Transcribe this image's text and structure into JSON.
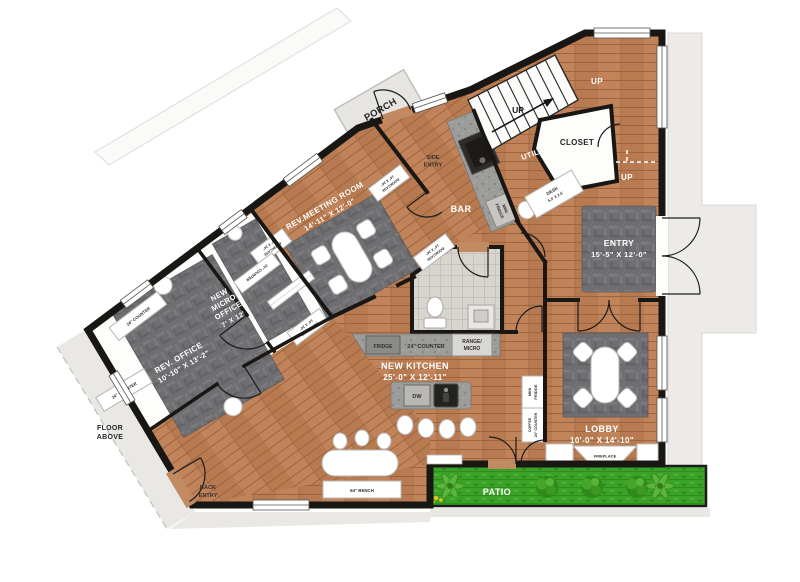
{
  "plan": {
    "rooms": {
      "meeting": {
        "name": "REV.MEETING ROOM",
        "dims": "14'-11\" X 12'-0\""
      },
      "micro": {
        "l1": "NEW",
        "l2": "MICRO",
        "l3": "OFFICE",
        "dims": "7' X 12'"
      },
      "office": {
        "name": "REV. OFFICE",
        "dims": "10'-10\" X 13'-2\""
      },
      "entry": {
        "name": "ENTRY",
        "dims": "15'-5\" X 12'-0\""
      },
      "kitchen": {
        "name": "NEW KITCHEN",
        "dims": "25'-0\" X 12'-11\""
      },
      "lobby": {
        "name": "LOBBY",
        "dims": "10'-0\" X 14'-10\""
      },
      "porch": "PORCH",
      "bar": "BAR",
      "util": "UTIL",
      "closet": "CLOSET",
      "patio": "PATIO",
      "side_entry": {
        "l1": "SIDE",
        "l2": "ENTRY"
      },
      "back_entry": {
        "l1": "BACK",
        "l2": "ENTRY"
      },
      "floor_above": {
        "l1": "FLOOR",
        "l2": "ABOVE"
      }
    },
    "fixtures": {
      "up": "UP",
      "fridge": "FRIDGE",
      "counter24": "24\" COUNTER",
      "range_l1": "RANGE/",
      "range_l2": "MICRO",
      "dw": "DW",
      "fireplace": "FIREPLACE",
      "bench": "64\" BENCH",
      "desk": {
        "l1": "DESK",
        "l2": "5.5' X 2.5'"
      },
      "bookcase": {
        "l1": "BOOKCASE",
        "l2": "14\" X 24\""
      },
      "mini_fridge": {
        "l1": "MINI",
        "l2": "FRIDGE"
      },
      "coffee": {
        "l1": "COFFEE",
        "l2": "24\" COUNTER"
      }
    },
    "colors": {
      "wood": "#b87a50",
      "carpet": "#6f6e71",
      "wall": "#191714",
      "grass": "#3aa226",
      "neighbor": "#e9e8e5",
      "granite": "#9c9c9a"
    }
  }
}
